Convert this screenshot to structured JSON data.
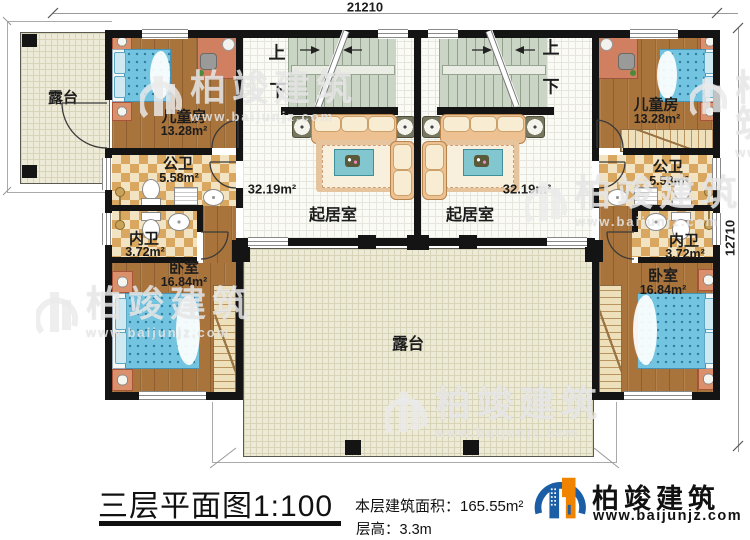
{
  "dimensions": {
    "top": "21210",
    "right": "12710"
  },
  "stairs": {
    "up": "上",
    "down": "下"
  },
  "watermark": {
    "brand": "柏竣建筑",
    "url": "www.baijunjz.com"
  },
  "rooms": {
    "terrace_top_left": {
      "name": "露台"
    },
    "terrace_bottom": {
      "name": "露台"
    },
    "left": {
      "kids": {
        "name": "儿童房",
        "area": "13.28m²"
      },
      "public_bath": {
        "name": "公卫",
        "area": "5.58m²"
      },
      "private_bath": {
        "name": "内卫",
        "area": "3.72m²"
      },
      "bedroom": {
        "name": "卧室",
        "area": "16.84m²"
      },
      "living": {
        "name": "起居室",
        "area": "32.19m²"
      }
    },
    "right": {
      "kids": {
        "name": "儿童房",
        "area": "13.28m²"
      },
      "public_bath": {
        "name": "公卫",
        "area": "5.58m²"
      },
      "private_bath": {
        "name": "内卫",
        "area": "3.72m²"
      },
      "bedroom": {
        "name": "卧室",
        "area": "16.84m²"
      },
      "living": {
        "name": "起居室",
        "area": "32.19m²"
      }
    }
  },
  "title_block": {
    "title": "三层平面图1:100",
    "area_line": "本层建筑面积：165.55m²",
    "height_line": "层高：3.3m"
  },
  "logo": {
    "brand": "柏竣建筑",
    "url": "www.baijunjz.com"
  }
}
